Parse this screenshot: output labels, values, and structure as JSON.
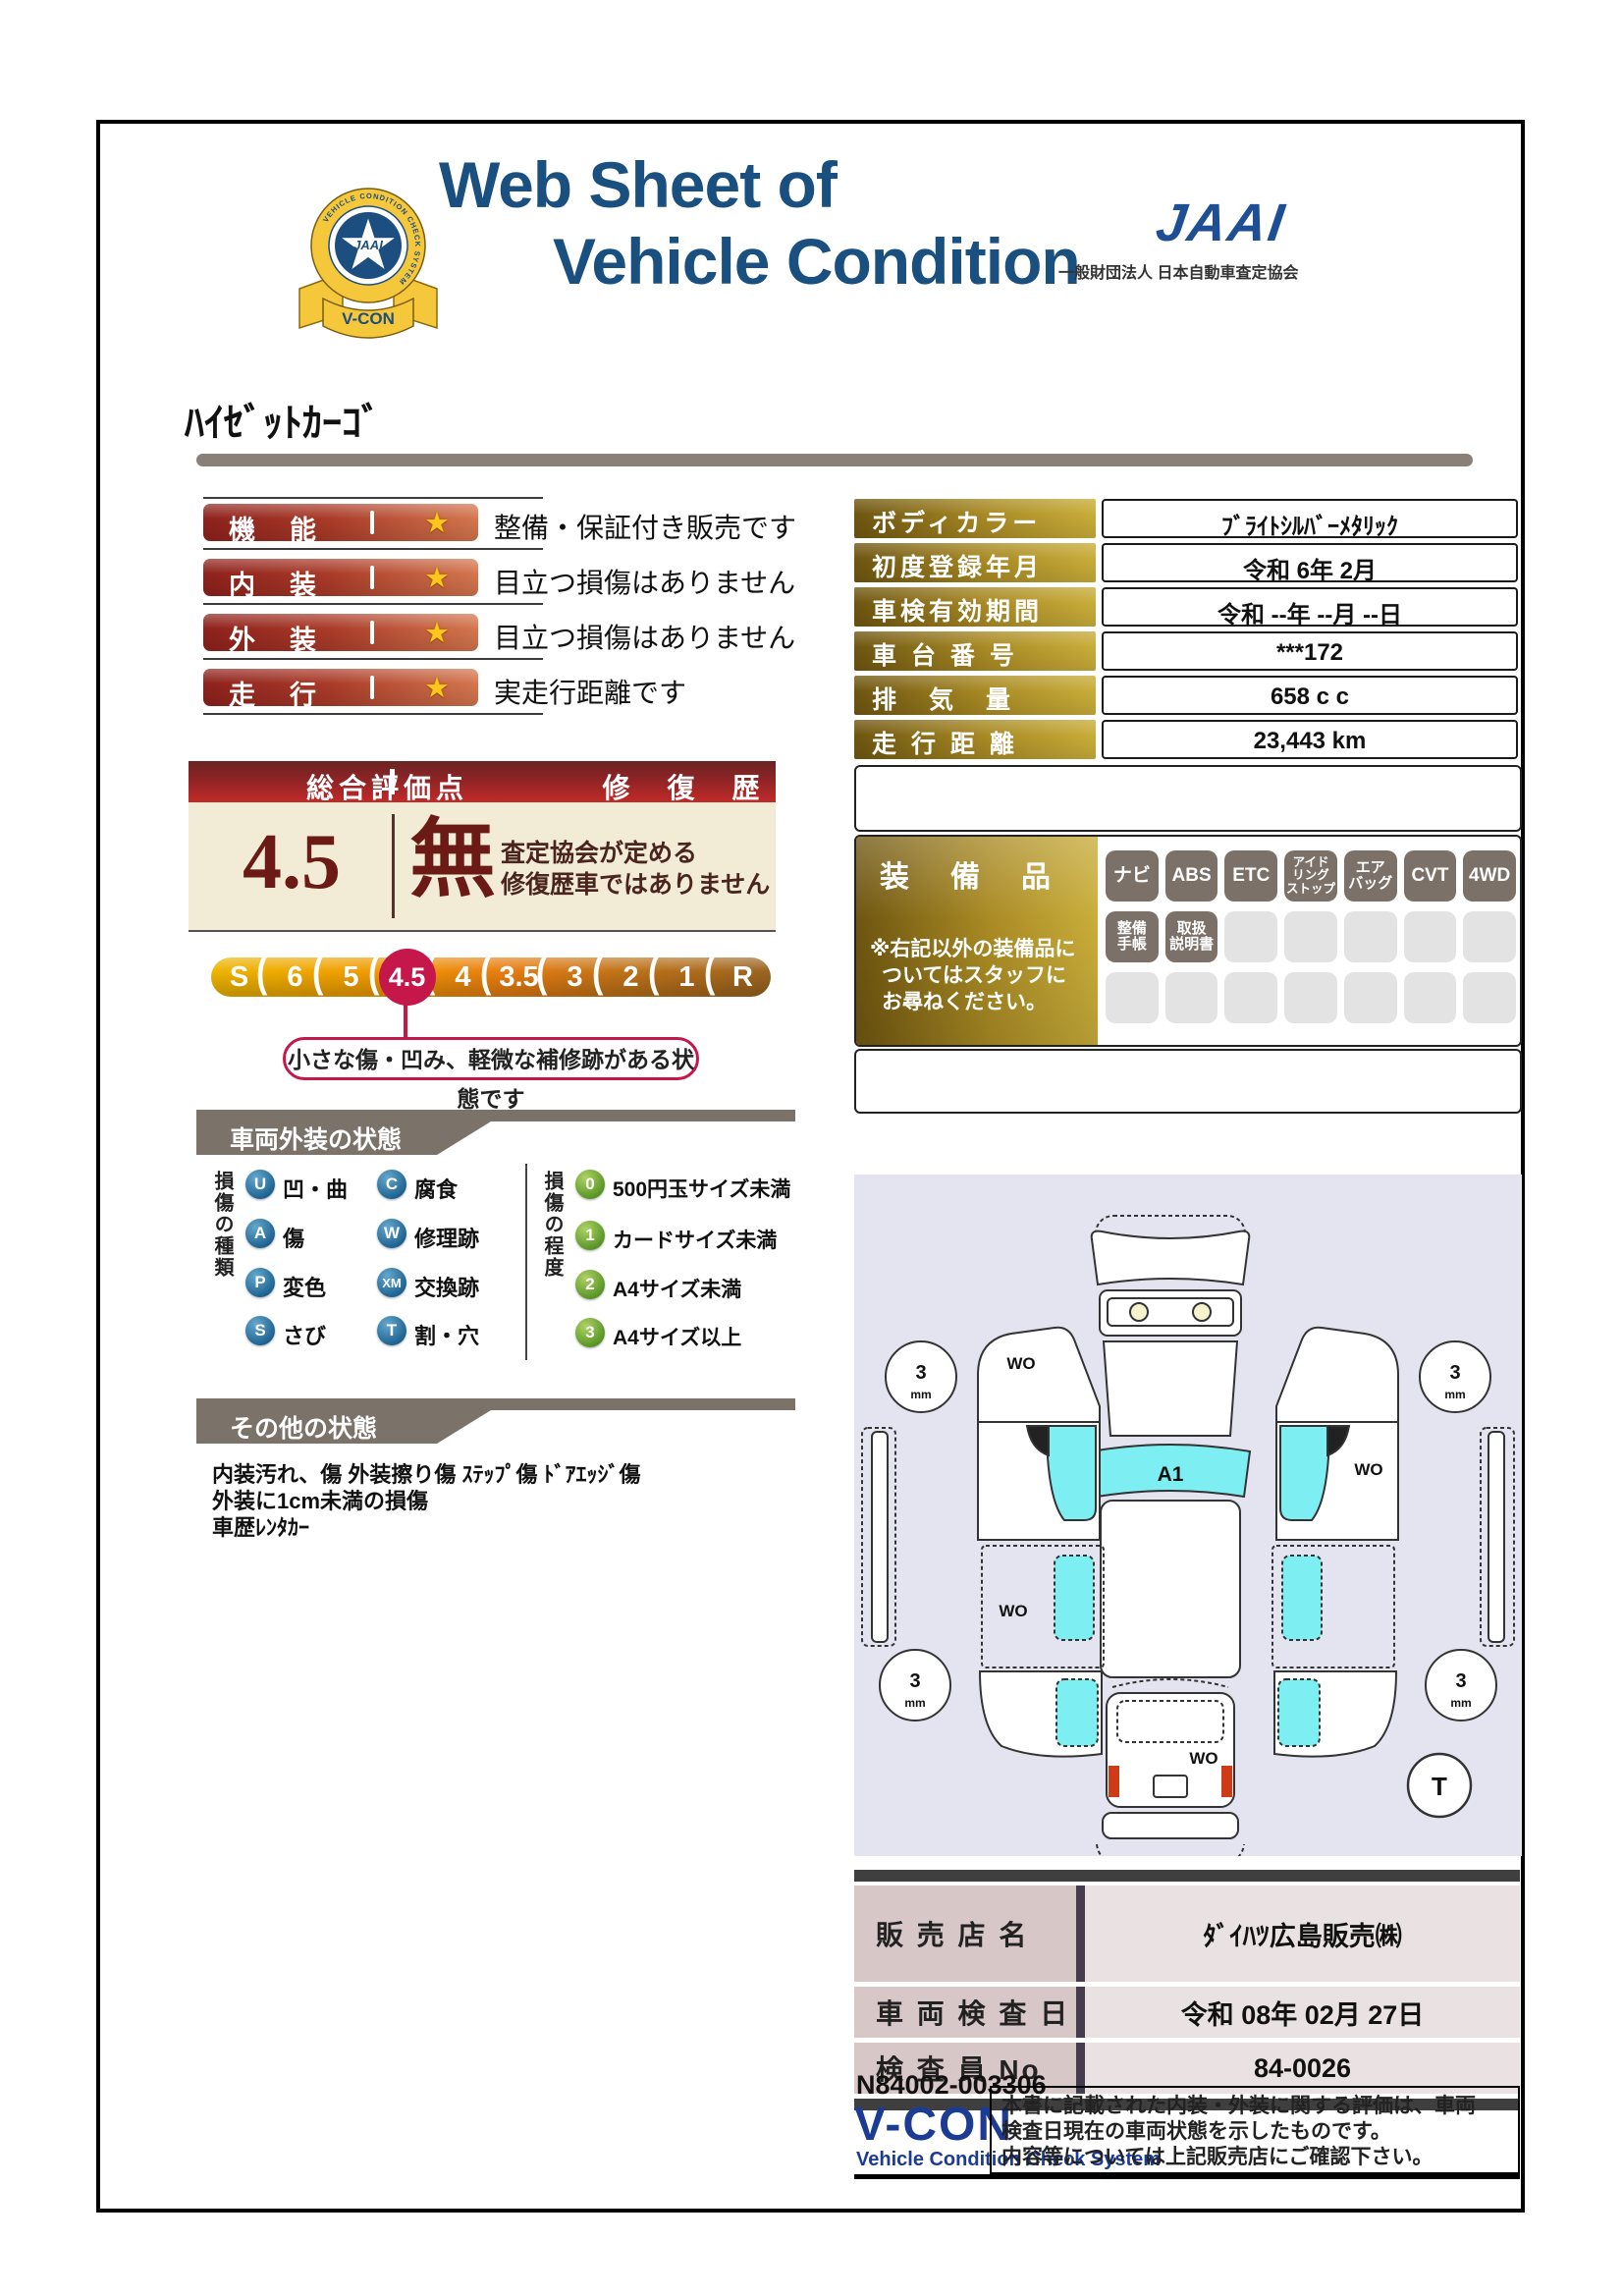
{
  "colors": {
    "accent_red": "#c5174a",
    "navy": "#1c3c94",
    "title_blue": "#1a5080",
    "gold": "#a9882a"
  },
  "header": {
    "title1": "Web Sheet of",
    "title2": "Vehicle Condition",
    "jaai_mark": "JAAI",
    "jaai_org": "一般財団法人 日本自動車査定協会",
    "emblem_ring": "VEHICLE CONDITION CHECK SYSTEM",
    "emblem_center": "JAAI",
    "emblem_ribbon": "V-CON"
  },
  "vehicle_name": "ﾊｲｾﾞｯﾄｶｰｺﾞ",
  "ratings": {
    "star": "★",
    "rows": [
      {
        "label": "機　能",
        "note": "整備・保証付き販売です"
      },
      {
        "label": "内　装",
        "note": "目立つ損傷はありません"
      },
      {
        "label": "外　装",
        "note": "目立つ損傷はありません"
      },
      {
        "label": "走　行",
        "note": "実走行距離です"
      }
    ]
  },
  "overall": {
    "header_left": "総合評価点",
    "header_right": "修　復　歴",
    "score": "4.5",
    "repair_flag": "無",
    "repair_note1": "査定協会が定める",
    "repair_note2": "修復歴車ではありません",
    "scale": [
      "S",
      "6",
      "5",
      "4.5",
      "4",
      "3.5",
      "3",
      "2",
      "1",
      "R"
    ],
    "selected": "4.5",
    "note": "小さな傷・凹み、軽微な補修跡がある状態です"
  },
  "info": {
    "rows": [
      {
        "label": "ボディカラー",
        "value": "ﾌﾞﾗｲﾄｼﾙﾊﾞｰﾒﾀﾘｯｸ"
      },
      {
        "label": "初度登録年月",
        "value": "令和 6年 2月"
      },
      {
        "label": "車検有効期間",
        "value": "令和 --年 --月 --日"
      },
      {
        "label": "車 台 番 号",
        "value": "***172"
      },
      {
        "label": "排　気　量",
        "value": "658 c c"
      },
      {
        "label": "走 行 距 離",
        "value": "23,443 km"
      }
    ]
  },
  "equipment": {
    "title": "装　備　品",
    "note1": "※右記以外の装備品に",
    "note2": "ついてはスタッフに",
    "note3": "お尋ねください。",
    "badges": [
      "ナビ",
      "ABS",
      "ETC",
      "アイド\nリング\nストップ",
      "エア\nバッグ",
      "CVT",
      "4WD",
      "整備\n手帳",
      "取扱\n説明書"
    ]
  },
  "exterior": {
    "title": "車両外装の状態",
    "type_label": "損傷の種類",
    "types": [
      {
        "code": "U",
        "label": "凹・曲"
      },
      {
        "code": "C",
        "label": "腐食"
      },
      {
        "code": "A",
        "label": "傷"
      },
      {
        "code": "W",
        "label": "修理跡"
      },
      {
        "code": "P",
        "label": "変色"
      },
      {
        "code": "XM",
        "label": "交換跡"
      },
      {
        "code": "S",
        "label": "さび"
      },
      {
        "code": "T",
        "label": "割・穴"
      }
    ],
    "grade_label": "損傷の程度",
    "grades": [
      {
        "code": "0",
        "label": "500円玉サイズ未満"
      },
      {
        "code": "1",
        "label": "カードサイズ未満"
      },
      {
        "code": "2",
        "label": "A4サイズ未満"
      },
      {
        "code": "3",
        "label": "A4サイズ以上"
      }
    ]
  },
  "other": {
    "title": "その他の状態",
    "lines": [
      "内装汚れ、傷 外装擦り傷 ｽﾃｯﾌﾟ傷 ﾄﾞｱｴｯｼﾞ傷",
      "外装に1cm未満の損傷",
      "車歴ﾚﾝﾀｶｰ"
    ]
  },
  "diagram": {
    "a1": "A1",
    "wo": "WO",
    "wheel": "3",
    "wheel_unit": "mm",
    "t": "T"
  },
  "dealer": {
    "rows": [
      {
        "label": "販 売 店 名",
        "value": "ﾀﾞｲﾊﾂ広島販売㈱"
      },
      {
        "label": "車 両 検 査 日",
        "value": "令和 08年 02月 27日"
      },
      {
        "label": "検 査 員 No",
        "value": "84-0026"
      }
    ]
  },
  "footer": {
    "serial": "N84002-003306",
    "vcon": "V-CON",
    "vcon_sub": "Vehicle Condition Check System",
    "note_lines": [
      "本書に記載された内装・外装に関する評価は、車両",
      "検査日現在の車両状態を示したものです。",
      "内容等については上記販売店にご確認下さい。"
    ]
  }
}
